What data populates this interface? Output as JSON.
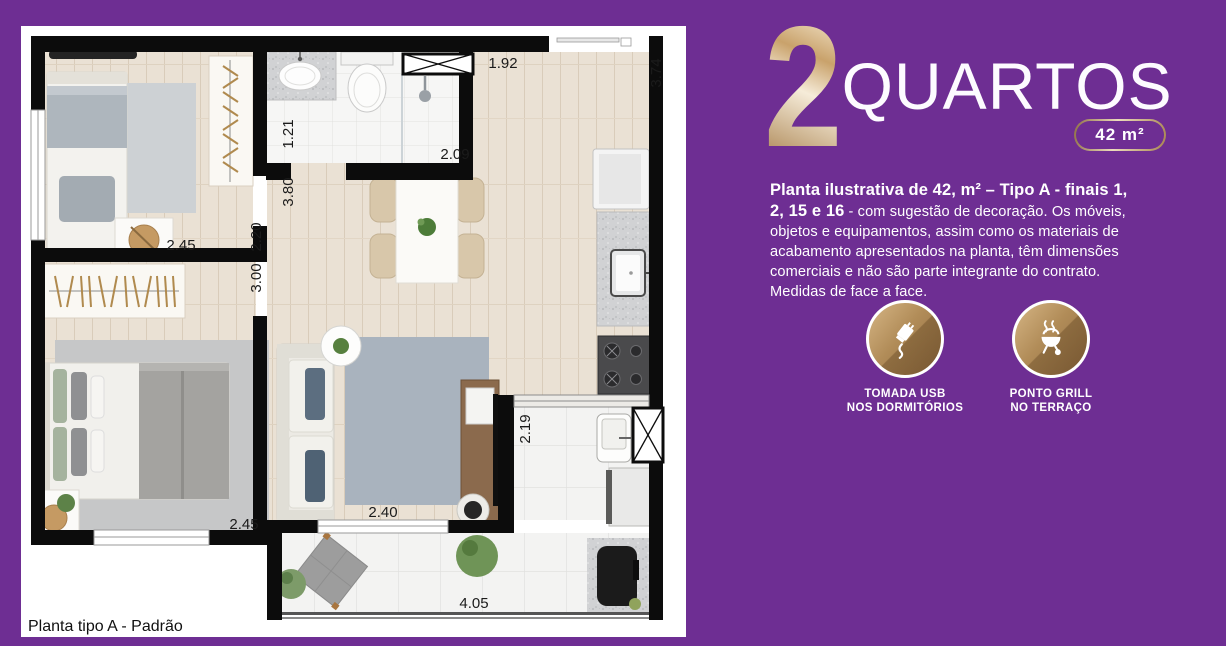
{
  "colors": {
    "background": "#6e2e93",
    "gold": "#b9945f",
    "wall": "#0c0c0c"
  },
  "floorplan": {
    "caption": "Planta tipo A - Padrão",
    "measurements": {
      "entry_hall_width": "1.92",
      "kitchen_length": "3.74",
      "bathroom_width": "1.21",
      "bathroom_length": "2.09",
      "hall_length": "3.80",
      "bedroom1_length": "2.20",
      "bedroom2_length": "3.00",
      "bedroom1_width": "2.45",
      "bedroom2_width": "2.45",
      "living_width": "2.40",
      "service_width": "2.19",
      "terrace_width": "4.05"
    }
  },
  "panel": {
    "title": {
      "number": "2",
      "word": "QUARTOS"
    },
    "area_badge": "42 m²",
    "description": {
      "bold": "Planta ilustrativa de 42, m² – Tipo A - finais 1, 2, 15 e 16",
      "regular": " - com sugestão de decoração. Os móveis, objetos e equipamentos, assim como os materiais de acabamento apresentados na planta, têm dimensões comerciais e não são parte integrante do contrato. Medidas de face a face."
    },
    "features": [
      {
        "icon": "usb-outlet-icon",
        "line1": "TOMADA USB",
        "line2": "NOS DORMITÓRIOS"
      },
      {
        "icon": "grill-icon",
        "line1": "PONTO GRILL",
        "line2": "NO TERRAÇO"
      }
    ]
  }
}
